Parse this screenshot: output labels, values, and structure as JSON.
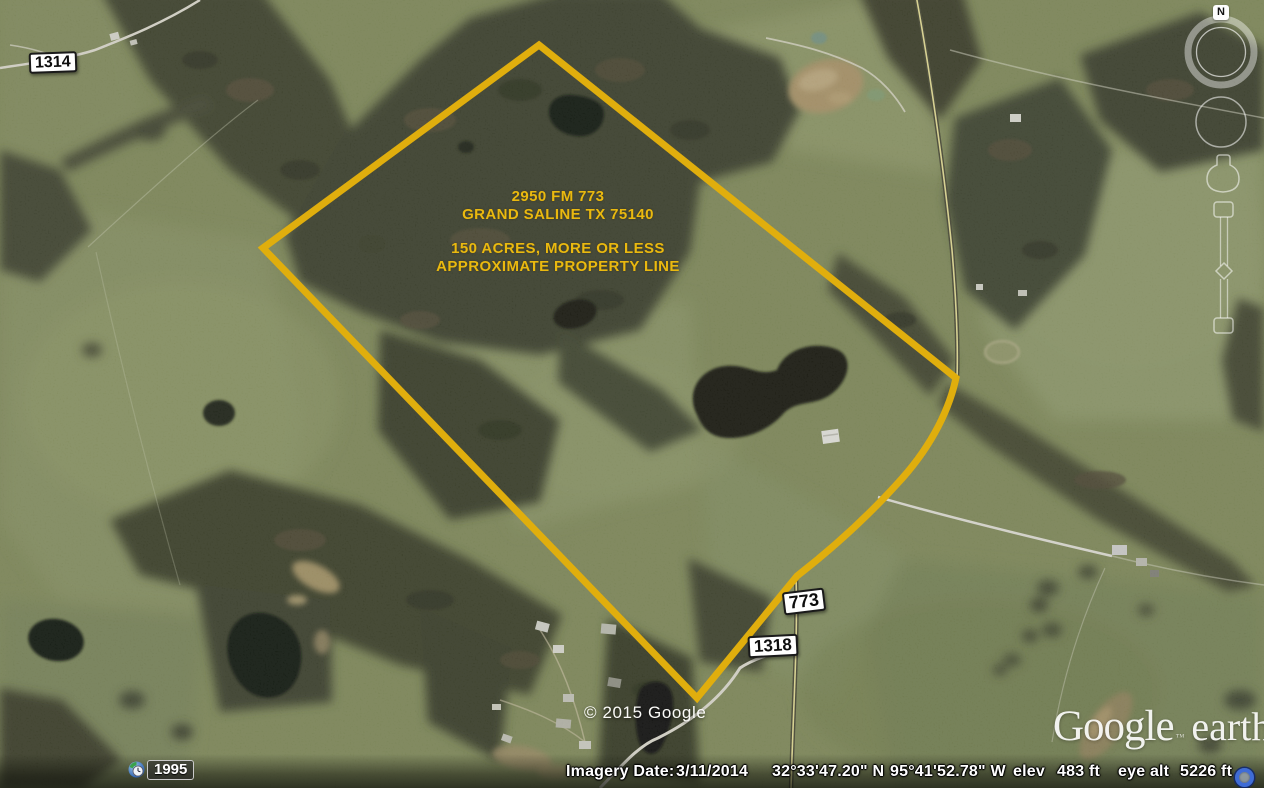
{
  "overlay": {
    "property_label": {
      "address_line1": "2950 FM 773",
      "address_line2": "GRAND SALINE TX 75140",
      "acreage_line": "150 ACRES, MORE OR LESS",
      "boundary_line": "APPROXIMATE PROPERTY LINE",
      "text_color": "#eab90f",
      "boundary_color": "#e0ae0d"
    },
    "road_badges": [
      {
        "id": "fm-1314",
        "label": "1314"
      },
      {
        "id": "fm-773",
        "label": "773"
      },
      {
        "id": "fm-1318",
        "label": "1318"
      }
    ],
    "copyright": "© 2015 Google",
    "logo": {
      "word1": "Google",
      "tm": "™",
      "word2": "earth"
    }
  },
  "controls": {
    "compass_north": "N",
    "time_badge_year": "1995"
  },
  "status_bar": {
    "imagery_date_label": "Imagery Date:",
    "imagery_date": "3/11/2014",
    "latitude": "32°33'47.20\" N",
    "longitude": "95°41'52.78\" W",
    "elev_label": "elev",
    "elevation": "483 ft",
    "eye_alt_label": "eye alt",
    "eye_altitude": "5226 ft"
  }
}
